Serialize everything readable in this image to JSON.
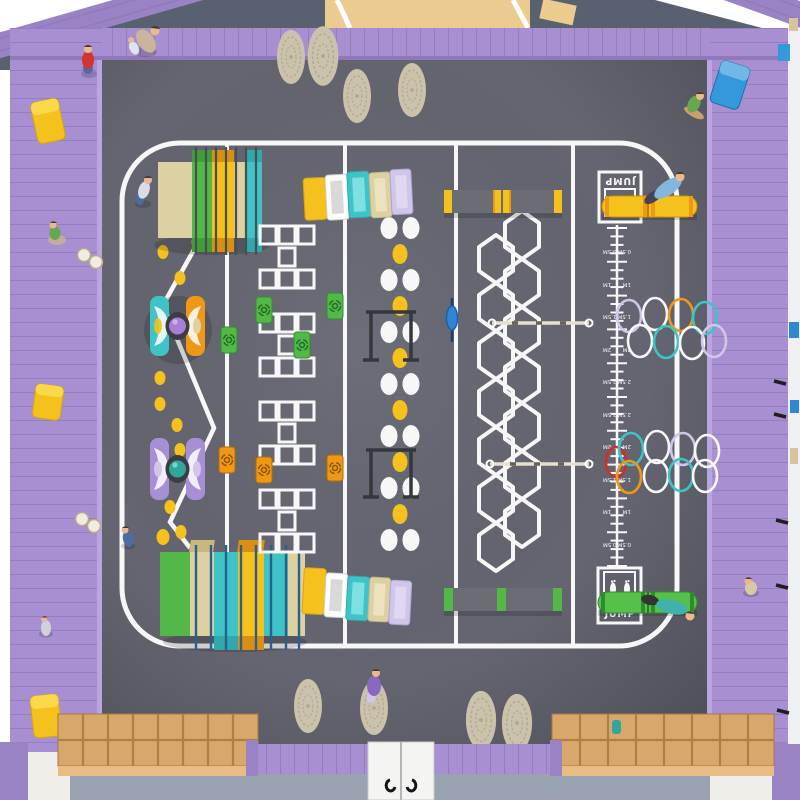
{
  "labels": {
    "jump_top": "JUMP",
    "jump_bottom": "JUMP"
  },
  "ruler": {
    "labels": [
      "0.5M",
      "1M",
      "1.5M",
      "2M",
      "2.5M",
      "2.5M",
      "2M",
      "1.5M",
      "1M",
      "0.5M"
    ]
  },
  "palette": {
    "wall": "#a78fd2",
    "wallLine": "#8f79b9",
    "wallShade": "#9a83c4",
    "outsideTop": "#596070",
    "corridorTan": "#eccb90",
    "floorOutside": "#f0eee9",
    "grayBlue": "#9aa3b1",
    "floor": "#646570",
    "white": "#f7f7f7",
    "yellow": "#f5c11c",
    "orange": "#ef9816",
    "green": "#53b848",
    "greenDark": "#2f8f2f",
    "teal": "#3ec4c6",
    "beige": "#ddd0a3",
    "purpleMat": "#a78fd6",
    "lavender": "#cfc6e9",
    "blue": "#2f86d2",
    "navy": "#2c5f8a",
    "red": "#cf2e2e",
    "wood": "#d8a76b",
    "woodDark": "#b07f42",
    "woodFace": "#e7bd85",
    "pouf": "#cbc2ac",
    "poufLine": "#b2a88e",
    "beamGray": "#6b6d74",
    "dark": "#3a3d42",
    "skin": "#eab991",
    "hair": "#4f3524",
    "shirtRed": "#d23434",
    "shirtGreen": "#67a84e",
    "shirtBlue": "#85b6dd",
    "shirtTeal": "#3fb3ab",
    "shirtPurple": "#8a68c0",
    "denim": "#4a6da8",
    "board": "#c9a06a",
    "doorWhite": "#f4f4f2"
  }
}
